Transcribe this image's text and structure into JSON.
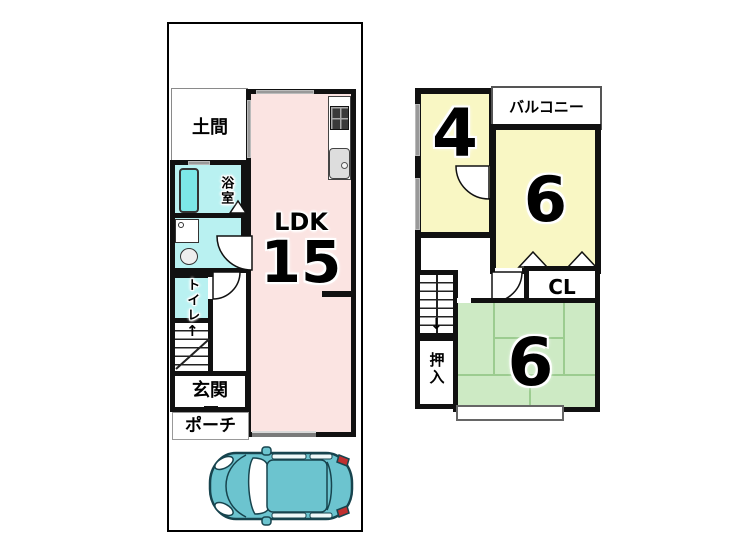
{
  "floor1": {
    "doma": "土間",
    "bath": "浴室",
    "toilet": "トイレ",
    "genkan": "玄関",
    "porch": "ポーチ",
    "ldk_label": "LDK",
    "ldk_size": "15",
    "stairs_up_arrow": "↑"
  },
  "floor2": {
    "room4_size": "4",
    "balcony": "バルコニー",
    "room6_yellow_size": "6",
    "closet": "CL",
    "oshiire": "押入",
    "room6_green_size": "6",
    "stairs_down_arrow": "↓"
  },
  "colors": {
    "ldk_pink": "#fbe4e2",
    "room_yellow": "#f9f7c4",
    "room_green": "#cdeac4",
    "wet_area_cyan": "#b9f1f1",
    "bathtub_cyan": "#7ce7e7",
    "car_teal": "#6cc4cf",
    "wall_black": "#111111"
  },
  "icons": {
    "car": "car-top-view",
    "stove": "gas-stove",
    "sink": "kitchen-sink",
    "bathtub": "bathtub",
    "washing_machine": "washing-machine",
    "wash_basin": "wash-basin",
    "stairs_first_floor": "stairs-up",
    "stairs_second_floor": "stairs-down"
  }
}
